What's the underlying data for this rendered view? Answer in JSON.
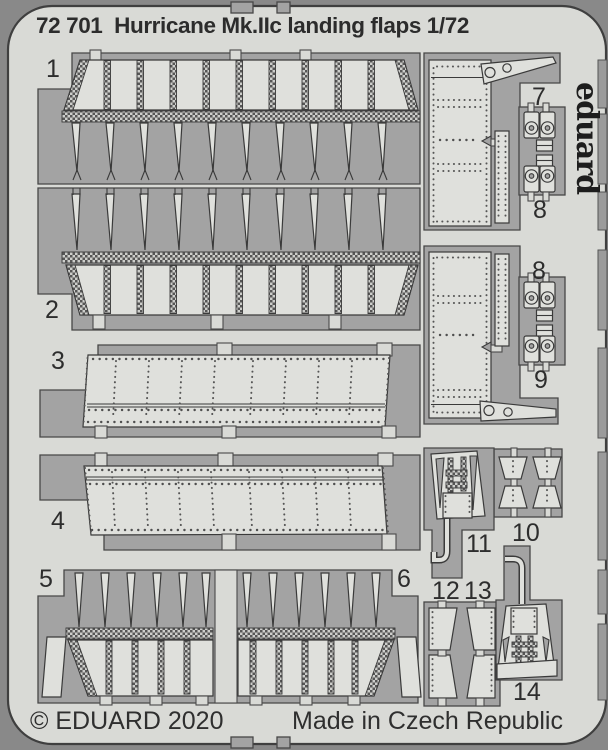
{
  "header": {
    "title": "72 701  Hurricane Mk.IIc landing flaps 1/72"
  },
  "footer": {
    "left": "© EDUARD 2020",
    "right": "Made in Czech Republic"
  },
  "brand": {
    "logo_vertical": "eduard"
  },
  "sheet": {
    "scale": "1/72",
    "subject": "Hurricane Mk.IIc landing flaps",
    "catalog_number": "72 701",
    "year": "2020"
  },
  "part_labels": [
    {
      "n": "1",
      "x": 46,
      "y": 57
    },
    {
      "n": "2",
      "x": 45,
      "y": 298
    },
    {
      "n": "3",
      "x": 51,
      "y": 349
    },
    {
      "n": "4",
      "x": 51,
      "y": 509
    },
    {
      "n": "5",
      "x": 39,
      "y": 567
    },
    {
      "n": "6",
      "x": 397,
      "y": 567
    },
    {
      "n": "7",
      "x": 532,
      "y": 85
    },
    {
      "n": "8",
      "x": 533,
      "y": 198
    },
    {
      "n": "8",
      "x": 532,
      "y": 259
    },
    {
      "n": "9",
      "x": 534,
      "y": 368
    },
    {
      "n": "10",
      "x": 512,
      "y": 521
    },
    {
      "n": "11",
      "x": 466,
      "y": 532
    },
    {
      "n": "12",
      "x": 432,
      "y": 579
    },
    {
      "n": "13",
      "x": 464,
      "y": 579
    },
    {
      "n": "14",
      "x": 513,
      "y": 680
    }
  ],
  "colors": {
    "background": "#898989",
    "sheet": "#d9dad6",
    "cutout": "#a3a3a3",
    "part": "#dfe0dc",
    "line": "#3a3a3a",
    "text": "#2c2c2c"
  }
}
